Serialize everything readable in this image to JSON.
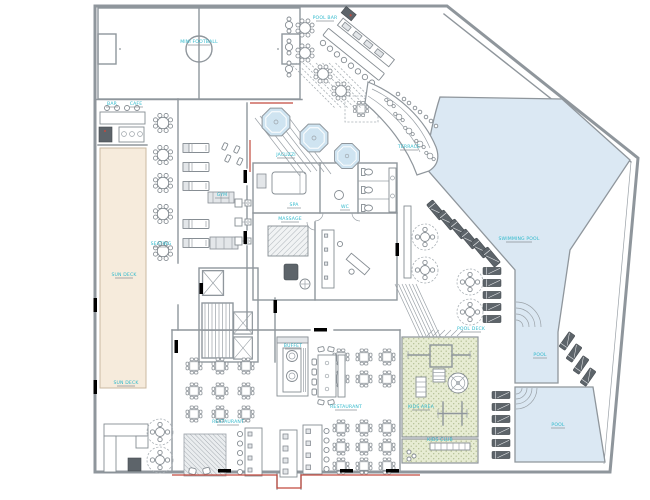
{
  "plan": {
    "type": "hotel-resort ground floor plan (CAD)",
    "labels": {
      "pitch": "MINI FOOTBALL",
      "pool_bar": "POOL BAR",
      "bar": "BAR",
      "cafe": "CAFE",
      "sun_deck_1": "SUN DECK",
      "sun_deck_2": "SUN DECK",
      "seating": "SEATING",
      "gym": "GYM",
      "jacuzzi": "JACUZZI",
      "spa": "SPA",
      "wc": "WC",
      "massage": "MASSAGE",
      "terrace": "TERRACE",
      "main_pool": "SWIMMING POOL",
      "pool_deck": "POOL DECK",
      "upper_pool": "POOL",
      "lower_pool": "POOL",
      "kids_area": "KIDS AREA",
      "kids_club": "KIDS CLUB",
      "restaurant_1": "RESTAURANT",
      "restaurant_2": "RESTAURANT",
      "buffet": "BUFFET"
    },
    "colors": {
      "wall_gray": "#8f969c",
      "pool_blue": "#dbe8f3",
      "deck_beige": "#f6ebdc",
      "kids_green": "#e7ecd3",
      "label_cyan": "#2fb9cc",
      "accent_red": "#c2493d",
      "door_blue": "#2f3f9b",
      "door_fill": "#a9cdf0",
      "furniture_dark": "#5d646a"
    }
  }
}
